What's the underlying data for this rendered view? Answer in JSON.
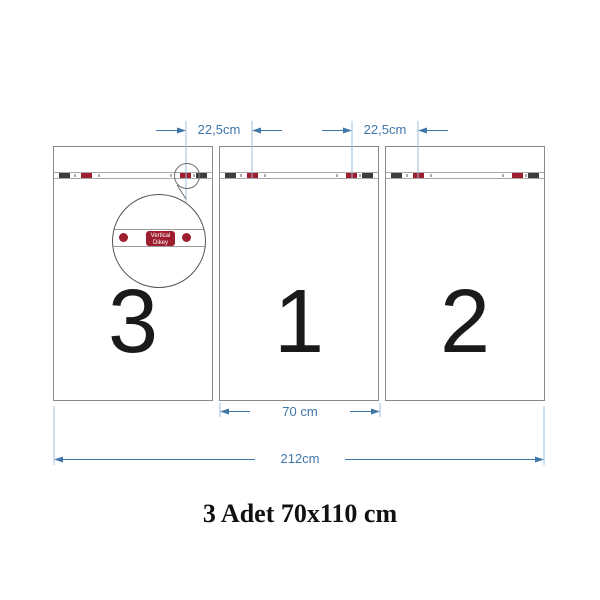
{
  "diagram": {
    "title": "3 Adet 70x110 cm",
    "panels": [
      {
        "number": "3"
      },
      {
        "number": "1"
      },
      {
        "number": "2"
      }
    ],
    "dimensions": {
      "spacing_left": "22,5cm",
      "spacing_right": "22,5cm",
      "panel_width": "70 cm",
      "total_width": "212cm"
    },
    "magnifier": {
      "label_line1": "Vertical",
      "label_line2": "Dikey"
    },
    "colors": {
      "dimension_blue": "#3f76a8",
      "extension_blue": "#9cc0de",
      "marker_red": "#9e1d2f",
      "marker_dark": "#3d3d3d",
      "panel_border": "#8a8a8a",
      "title_color": "#111111"
    }
  }
}
